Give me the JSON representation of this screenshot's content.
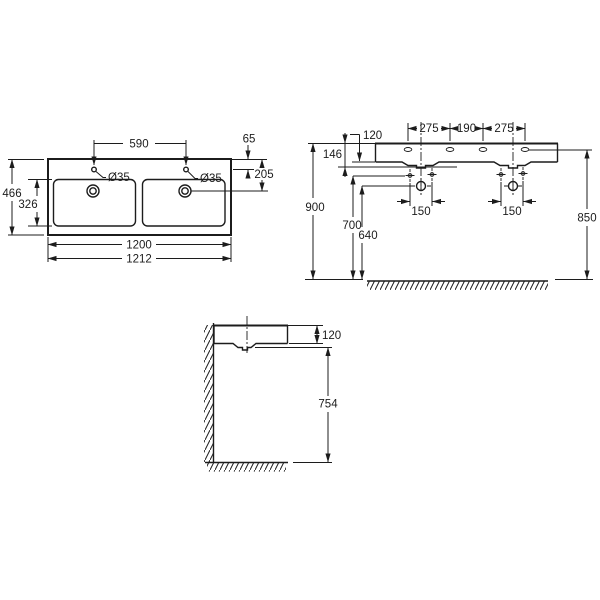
{
  "drawing": {
    "product": "double washbasin dimensional drawing",
    "plan_view": {
      "overall_width": "1212",
      "ceramic_width": "1200",
      "overall_depth": "466",
      "bowl_depth": "326",
      "tap_hole_spacing": "590",
      "tap_hole_edge_offset": "65",
      "drain_edge_offset": "205",
      "tap_hole_diameter_left": "Ø35",
      "tap_hole_diameter_right": "Ø35"
    },
    "front_view": {
      "tap_spacing_left": "275",
      "tap_spacing_center": "190",
      "tap_spacing_right": "275",
      "apron_height": "120",
      "fixture_depth": "146",
      "rim_height_from_floor": "900",
      "fixing_holes_height": "700",
      "drain_height": "640",
      "tap_deck_height": "850",
      "fixing_spacing_left": "150",
      "fixing_spacing_right": "150"
    },
    "side_view": {
      "apron_height": "120",
      "clearance_under_basin": "754"
    }
  },
  "colors": {
    "line": "#1c1c1c",
    "background": "#ffffff"
  }
}
